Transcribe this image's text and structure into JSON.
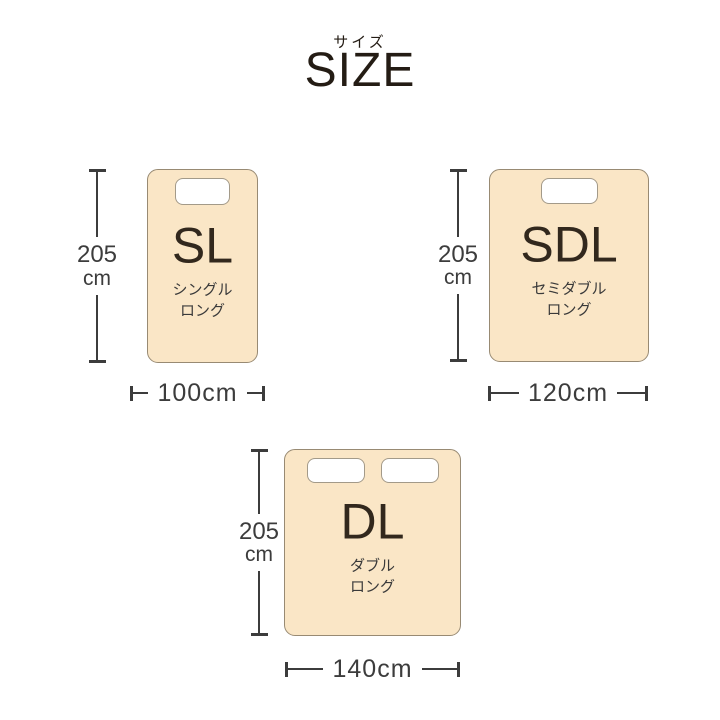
{
  "title": {
    "ja": "サイズ",
    "en": "SIZE"
  },
  "colors": {
    "heading": "#241c14",
    "code": "#32281d",
    "label": "#3a3a3a",
    "line": "#3c3c3c",
    "bed_fill": "#fae6c6",
    "bed_border": "#988a73",
    "pillow_border": "#a39a89"
  },
  "beds": [
    {
      "code": "SL",
      "name_line1": "シングル",
      "name_line2": "ロング",
      "height_value": "205",
      "height_unit": "cm",
      "width_label": "100cm",
      "pillow_count": 1
    },
    {
      "code": "SDL",
      "name_line1": "セミダブル",
      "name_line2": "ロング",
      "height_value": "205",
      "height_unit": "cm",
      "width_label": "120cm",
      "pillow_count": 1
    },
    {
      "code": "DL",
      "name_line1": "ダブル",
      "name_line2": "ロング",
      "height_value": "205",
      "height_unit": "cm",
      "width_label": "140cm",
      "pillow_count": 2
    }
  ]
}
